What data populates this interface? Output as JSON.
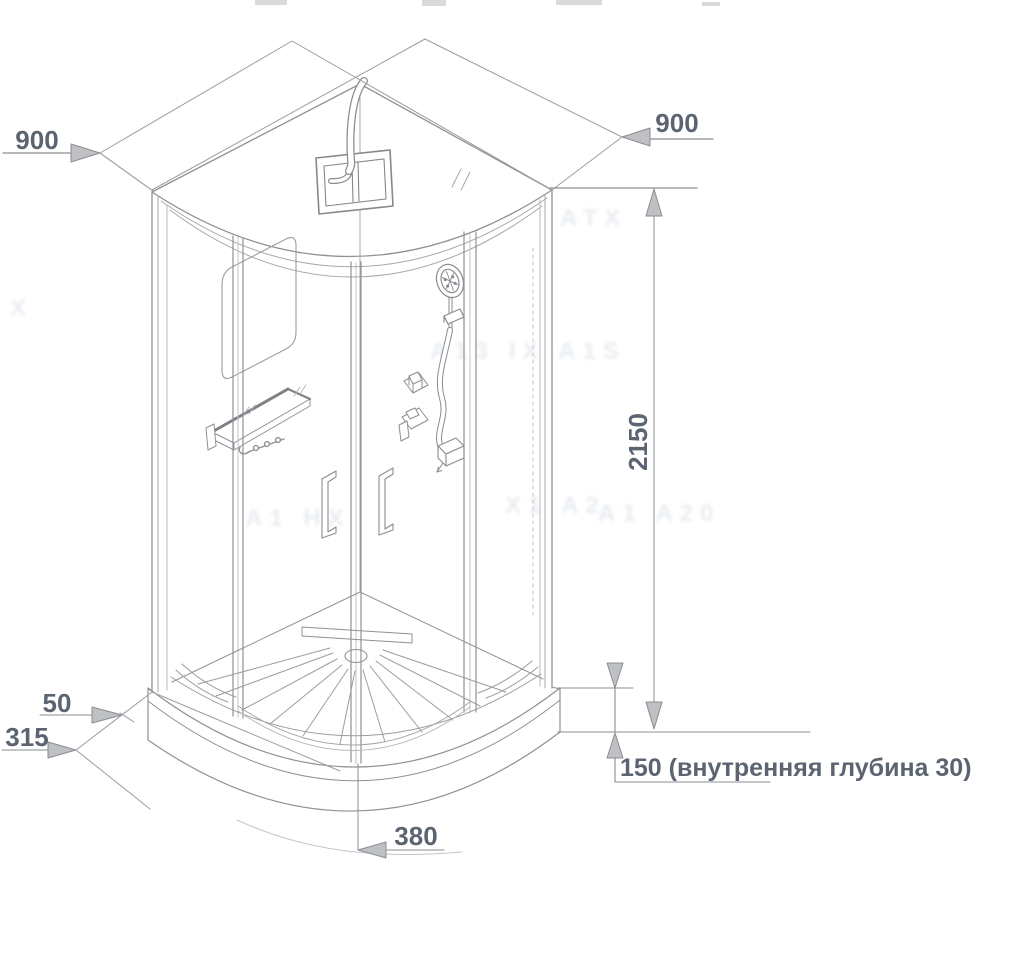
{
  "drawing": {
    "type": "shower-cabin-dimensional-drawing",
    "colors": {
      "background": "#ffffff",
      "drawing_line": "#8e9196",
      "light_line": "#a5a8ac",
      "dimension_line": "#8a8d92",
      "arrow_fill": "#bec0c3",
      "dimension_text": "#5c6471"
    }
  },
  "annotations": {
    "width_left": {
      "value": "900"
    },
    "width_right": {
      "value": "900"
    },
    "height": {
      "value": "2150"
    },
    "tray_front_edge": {
      "value": "50"
    },
    "tray_corner": {
      "value": "315"
    },
    "door_center_offset": {
      "value": "380"
    },
    "tray_height_note": {
      "value": "150 (внутренняя глубина 30)"
    }
  },
  "watermarks": [
    {
      "text": "X"
    },
    {
      "text": "A13 IX A1S"
    },
    {
      "text": "ATX"
    },
    {
      "text": "X1 A2"
    },
    {
      "text": "A1 HX"
    },
    {
      "text": "A1 A20"
    }
  ]
}
